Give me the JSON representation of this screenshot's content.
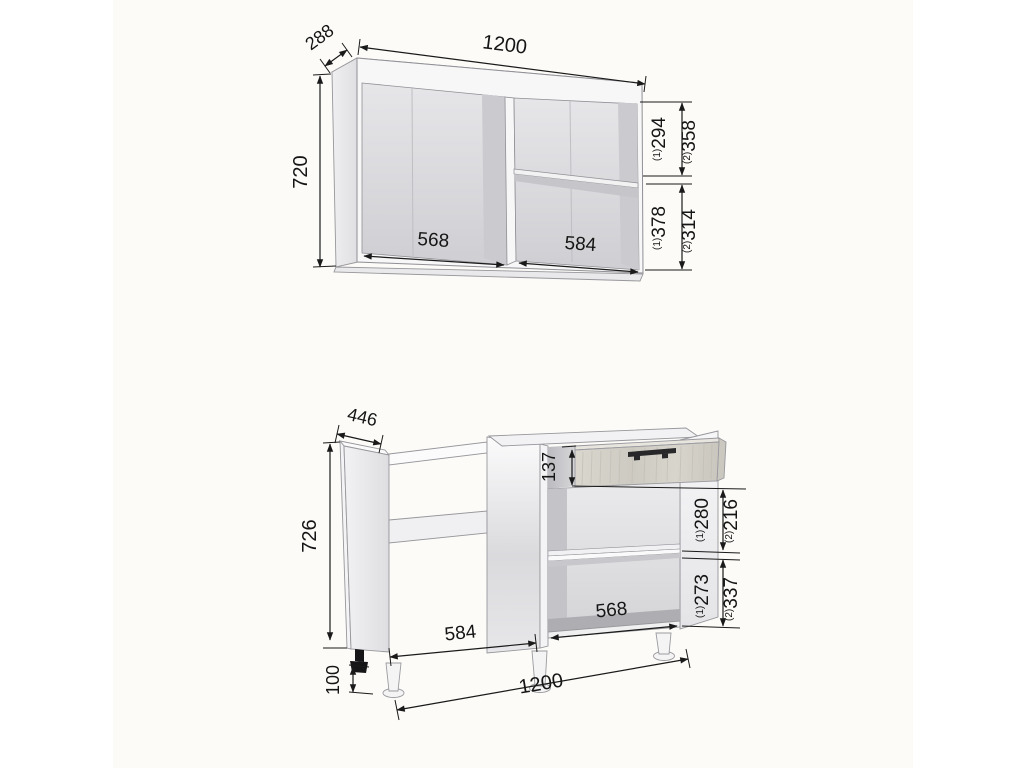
{
  "drawing": {
    "kind": "kitchen-cabinet-dimension-drawing",
    "units": "mm",
    "accent_colors": {
      "line": "#1a1a1a",
      "cabinet_edge": "#97979c",
      "wood": "#d2cfc7",
      "handle": "#28282b"
    }
  },
  "upper": {
    "width": "1200",
    "depth": "288",
    "height": "720",
    "opening_left_width": "568",
    "opening_right_width": "584",
    "shelf_dims": [
      {
        "variant": "(1)",
        "value": "294"
      },
      {
        "variant": "(2)",
        "value": "358"
      },
      {
        "variant": "(1)",
        "value": "378"
      },
      {
        "variant": "(2)",
        "value": "314"
      }
    ]
  },
  "lower": {
    "width": "1200",
    "depth": "446",
    "height": "726",
    "leg_height": "100",
    "drawer_height": "137",
    "opening_left_width": "584",
    "opening_right_width": "568",
    "shelf_dims": [
      {
        "variant": "(1)",
        "value": "280"
      },
      {
        "variant": "(2)",
        "value": "216"
      },
      {
        "variant": "(1)",
        "value": "273"
      },
      {
        "variant": "(2)",
        "value": "337"
      }
    ]
  }
}
